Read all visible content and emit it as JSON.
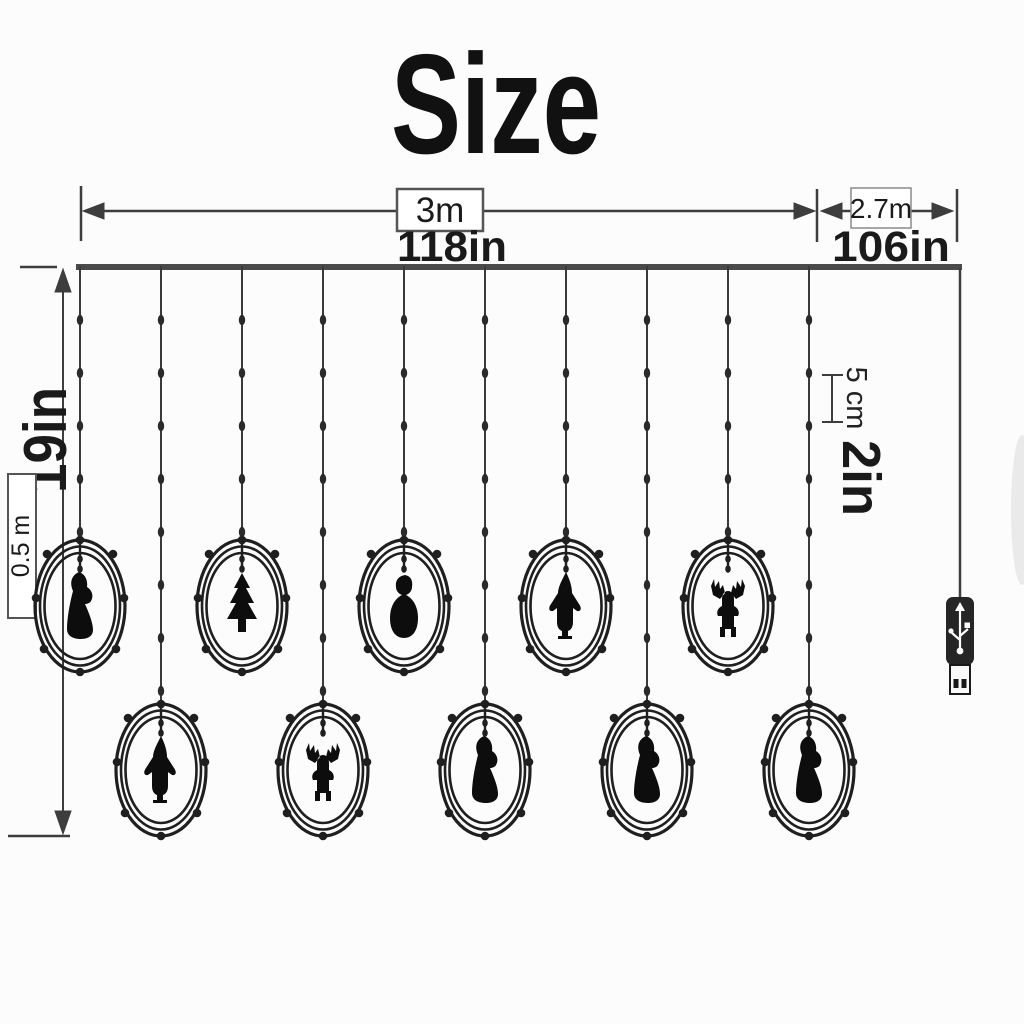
{
  "title": "Size",
  "colors": {
    "background": "#fcfcfc",
    "ink": "#1a1a1a",
    "dimension_line": "#3d3d3d",
    "curtain_bar": "#4a4a4a",
    "figure_silhouette": "#0d0d0d",
    "usb_body": "#262626"
  },
  "dimensions": {
    "main_width": {
      "metric": "3m",
      "imperial": "118in"
    },
    "lead_width": {
      "metric": "2.7m",
      "imperial": "106in"
    },
    "drop_height": {
      "metric": "0.5 m",
      "imperial": "19in"
    },
    "led_spacing": {
      "metric": "5 cm",
      "imperial": "2in"
    }
  },
  "curtain": {
    "string_count": 10,
    "rows": [
      "top",
      "bottom"
    ],
    "strings": [
      {
        "figure": "santa",
        "row": "top"
      },
      {
        "figure": "gnome",
        "row": "bottom"
      },
      {
        "figure": "tree",
        "row": "top"
      },
      {
        "figure": "reindeer",
        "row": "bottom"
      },
      {
        "figure": "snowman",
        "row": "top"
      },
      {
        "figure": "santa",
        "row": "bottom"
      },
      {
        "figure": "gnome",
        "row": "top"
      },
      {
        "figure": "santa",
        "row": "bottom"
      },
      {
        "figure": "reindeer",
        "row": "top"
      },
      {
        "figure": "santa",
        "row": "bottom"
      }
    ]
  },
  "icons": {
    "usb": "usb-trident-icon"
  }
}
